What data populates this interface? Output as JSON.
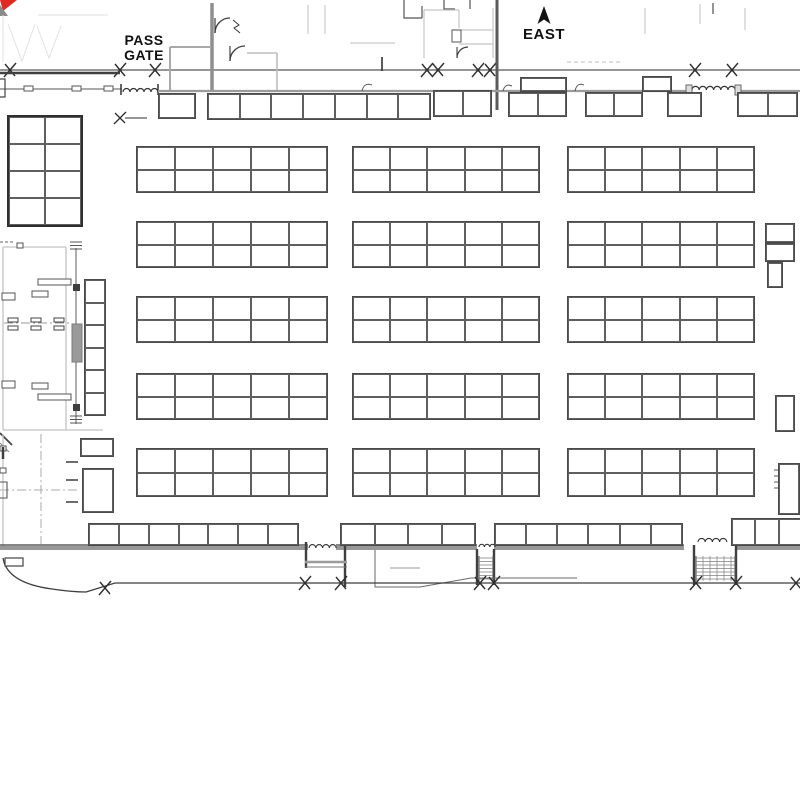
{
  "labels": {
    "pass_gate_line1": "PASS",
    "pass_gate_line2": "GATE",
    "compass_direction": "EAST"
  },
  "colors": {
    "background": "#ffffff",
    "booth_line": "#4a4a4a",
    "wall_dark": "#3f3f3f",
    "wall_gray": "#989898",
    "wall_light": "#c4c4c4",
    "logo_red": "#e02a20",
    "text": "#111111"
  },
  "booths": {
    "units": [
      {
        "x": 136,
        "y": 146,
        "w": 192,
        "h": 47,
        "cols": 5,
        "rows": 2
      },
      {
        "x": 352,
        "y": 146,
        "w": 188,
        "h": 47,
        "cols": 5,
        "rows": 2
      },
      {
        "x": 567,
        "y": 146,
        "w": 188,
        "h": 47,
        "cols": 5,
        "rows": 2
      },
      {
        "x": 136,
        "y": 221,
        "w": 192,
        "h": 47,
        "cols": 5,
        "rows": 2
      },
      {
        "x": 352,
        "y": 221,
        "w": 188,
        "h": 47,
        "cols": 5,
        "rows": 2
      },
      {
        "x": 567,
        "y": 221,
        "w": 188,
        "h": 47,
        "cols": 5,
        "rows": 2
      },
      {
        "x": 136,
        "y": 296,
        "w": 192,
        "h": 47,
        "cols": 5,
        "rows": 2
      },
      {
        "x": 352,
        "y": 296,
        "w": 188,
        "h": 47,
        "cols": 5,
        "rows": 2
      },
      {
        "x": 567,
        "y": 296,
        "w": 188,
        "h": 47,
        "cols": 5,
        "rows": 2
      },
      {
        "x": 136,
        "y": 373,
        "w": 192,
        "h": 47,
        "cols": 5,
        "rows": 2
      },
      {
        "x": 352,
        "y": 373,
        "w": 188,
        "h": 47,
        "cols": 5,
        "rows": 2
      },
      {
        "x": 567,
        "y": 373,
        "w": 188,
        "h": 47,
        "cols": 5,
        "rows": 2
      },
      {
        "x": 136,
        "y": 448,
        "w": 192,
        "h": 49,
        "cols": 5,
        "rows": 2
      },
      {
        "x": 352,
        "y": 448,
        "w": 188,
        "h": 49,
        "cols": 5,
        "rows": 2
      },
      {
        "x": 567,
        "y": 448,
        "w": 188,
        "h": 49,
        "cols": 5,
        "rows": 2
      },
      {
        "x": 7,
        "y": 115,
        "w": 76,
        "h": 112,
        "cols": 2,
        "rows": 4,
        "thick": true
      },
      {
        "x": 84,
        "y": 279,
        "w": 22,
        "h": 137,
        "cols": 1,
        "rows": 6
      },
      {
        "x": 158,
        "y": 93,
        "w": 38,
        "h": 26,
        "cols": 1,
        "rows": 1
      },
      {
        "x": 207,
        "y": 93,
        "w": 224,
        "h": 27,
        "cols": 7,
        "rows": 1
      },
      {
        "x": 433,
        "y": 90,
        "w": 59,
        "h": 27,
        "cols": 2,
        "rows": 1
      },
      {
        "x": 520,
        "y": 77,
        "w": 47,
        "h": 15,
        "cols": 1,
        "rows": 1
      },
      {
        "x": 508,
        "y": 92,
        "w": 59,
        "h": 25,
        "cols": 2,
        "rows": 1
      },
      {
        "x": 585,
        "y": 92,
        "w": 58,
        "h": 25,
        "cols": 2,
        "rows": 1
      },
      {
        "x": 642,
        "y": 76,
        "w": 30,
        "h": 16,
        "cols": 1,
        "rows": 1
      },
      {
        "x": 667,
        "y": 92,
        "w": 35,
        "h": 25,
        "cols": 1,
        "rows": 1
      },
      {
        "x": 737,
        "y": 92,
        "w": 61,
        "h": 25,
        "cols": 2,
        "rows": 1
      },
      {
        "x": 88,
        "y": 523,
        "w": 211,
        "h": 23,
        "cols": 7,
        "rows": 1
      },
      {
        "x": 340,
        "y": 523,
        "w": 136,
        "h": 23,
        "cols": 4,
        "rows": 1
      },
      {
        "x": 494,
        "y": 523,
        "w": 189,
        "h": 23,
        "cols": 6,
        "rows": 1
      },
      {
        "x": 731,
        "y": 518,
        "w": 72,
        "h": 28,
        "cols": 3,
        "rows": 1
      },
      {
        "x": 765,
        "y": 223,
        "w": 30,
        "h": 20,
        "cols": 1,
        "rows": 1
      },
      {
        "x": 765,
        "y": 243,
        "w": 30,
        "h": 19,
        "cols": 1,
        "rows": 1
      },
      {
        "x": 767,
        "y": 262,
        "w": 16,
        "h": 26,
        "cols": 1,
        "rows": 1
      },
      {
        "x": 775,
        "y": 395,
        "w": 20,
        "h": 37,
        "cols": 1,
        "rows": 1
      },
      {
        "x": 778,
        "y": 463,
        "w": 22,
        "h": 52,
        "cols": 1,
        "rows": 1
      },
      {
        "x": 80,
        "y": 438,
        "w": 34,
        "h": 19,
        "cols": 1,
        "rows": 1
      },
      {
        "x": 82,
        "y": 468,
        "w": 32,
        "h": 45,
        "cols": 1,
        "rows": 1
      }
    ]
  }
}
